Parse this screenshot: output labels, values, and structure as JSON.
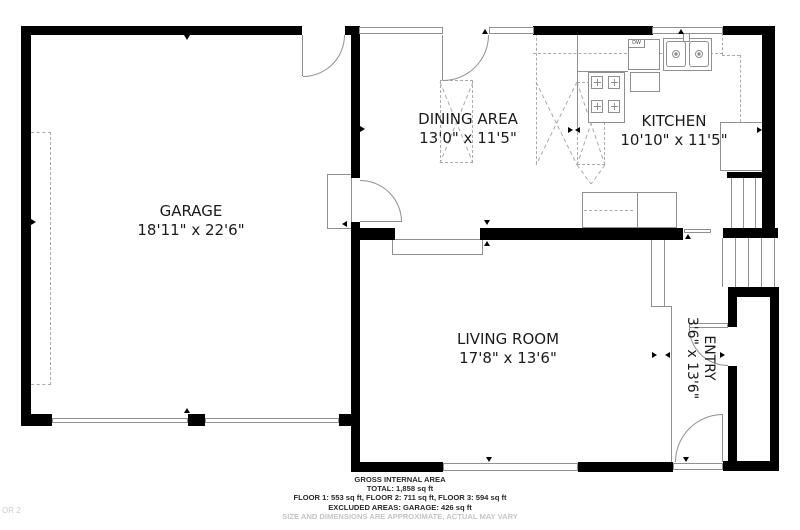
{
  "rooms": [
    {
      "name": "GARAGE",
      "dims": "18'11\" x 22'6\""
    },
    {
      "name": "DINING AREA",
      "dims": "13'0\" x 11'5\""
    },
    {
      "name": "KITCHEN",
      "dims": "10'10\" x 11'5\""
    },
    {
      "name": "LIVING ROOM",
      "dims": "17'8\" x 13'6\""
    },
    {
      "name": "ENTRY",
      "dims": "3'6\" x 13'6\""
    }
  ],
  "fixtures": {
    "dishwasher_label": "DW"
  },
  "footer": {
    "line1": "GROSS INTERNAL AREA",
    "line2": "TOTAL: 1,858 sq ft",
    "line3": "FLOOR 1: 553 sq ft, FLOOR 2: 711 sq ft, FLOOR 3: 594 sq ft",
    "line4": "EXCLUDED AREAS: GARAGE: 426 sq ft",
    "disclaimer": "SIZE AND DIMENSIONS ARE APPROXIMATE, ACTUAL MAY VARY"
  },
  "watermark": "OR 2",
  "colors": {
    "wall": "#000000",
    "thin_line": "#909090",
    "dashed_line": "#ababab",
    "label_text": "#1b1b1b",
    "footer_text": "#2a2a2a",
    "muted_text": "#c4c4c4",
    "background": "#ffffff"
  }
}
